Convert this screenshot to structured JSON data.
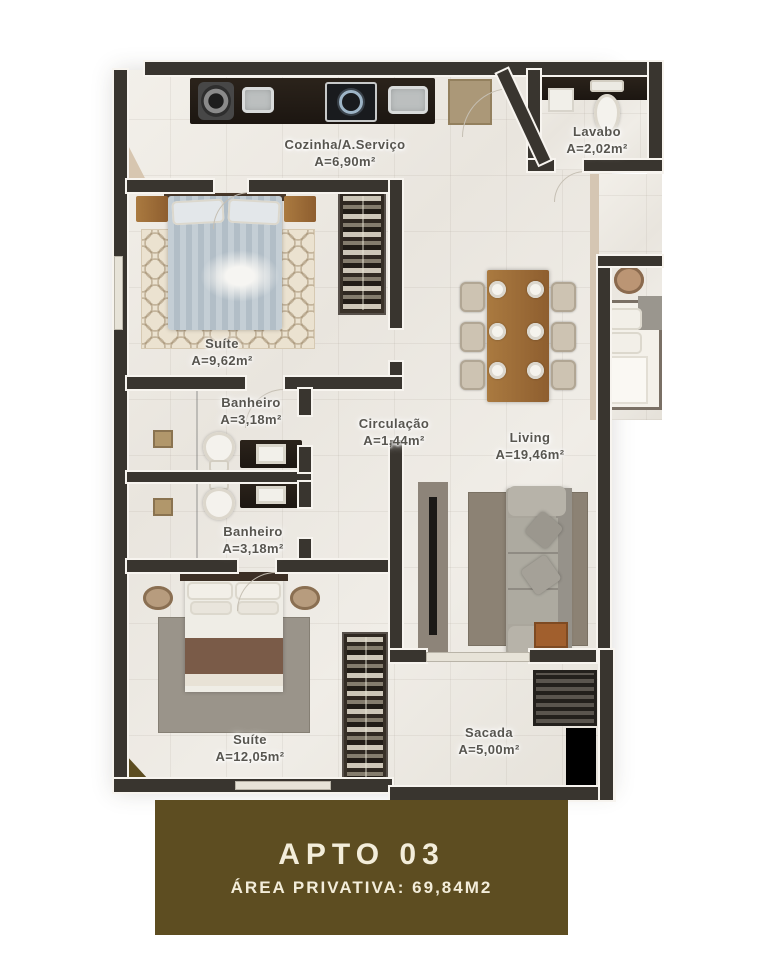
{
  "banner": {
    "title": "APTO 03",
    "subtitle": "ÁREA PRIVATIVA: 69,84M2"
  },
  "rooms": [
    {
      "name": "Cozinha/A.Serviço",
      "area": "A=6,90m²"
    },
    {
      "name": "Lavabo",
      "area": "A=2,02m²"
    },
    {
      "name": "Suíte",
      "area": "A=9,62m²"
    },
    {
      "name": "Banheiro",
      "area": "A=3,18m²"
    },
    {
      "name": "Circulação",
      "area": "A=1,44m²"
    },
    {
      "name": "Living",
      "area": "A=19,46m²"
    },
    {
      "name": "Banheiro",
      "area": "A=3,18m²"
    },
    {
      "name": "Suíte",
      "area": "A=12,05m²"
    },
    {
      "name": "Sacada",
      "area": "A=5,00m²"
    }
  ],
  "colors": {
    "banner_bg": "#5d4d21",
    "wall": "#39352f",
    "floor": "#edeae4",
    "dark_counter": "#221c17",
    "wood": "#9a6a3c",
    "label_text": "#57554f"
  }
}
